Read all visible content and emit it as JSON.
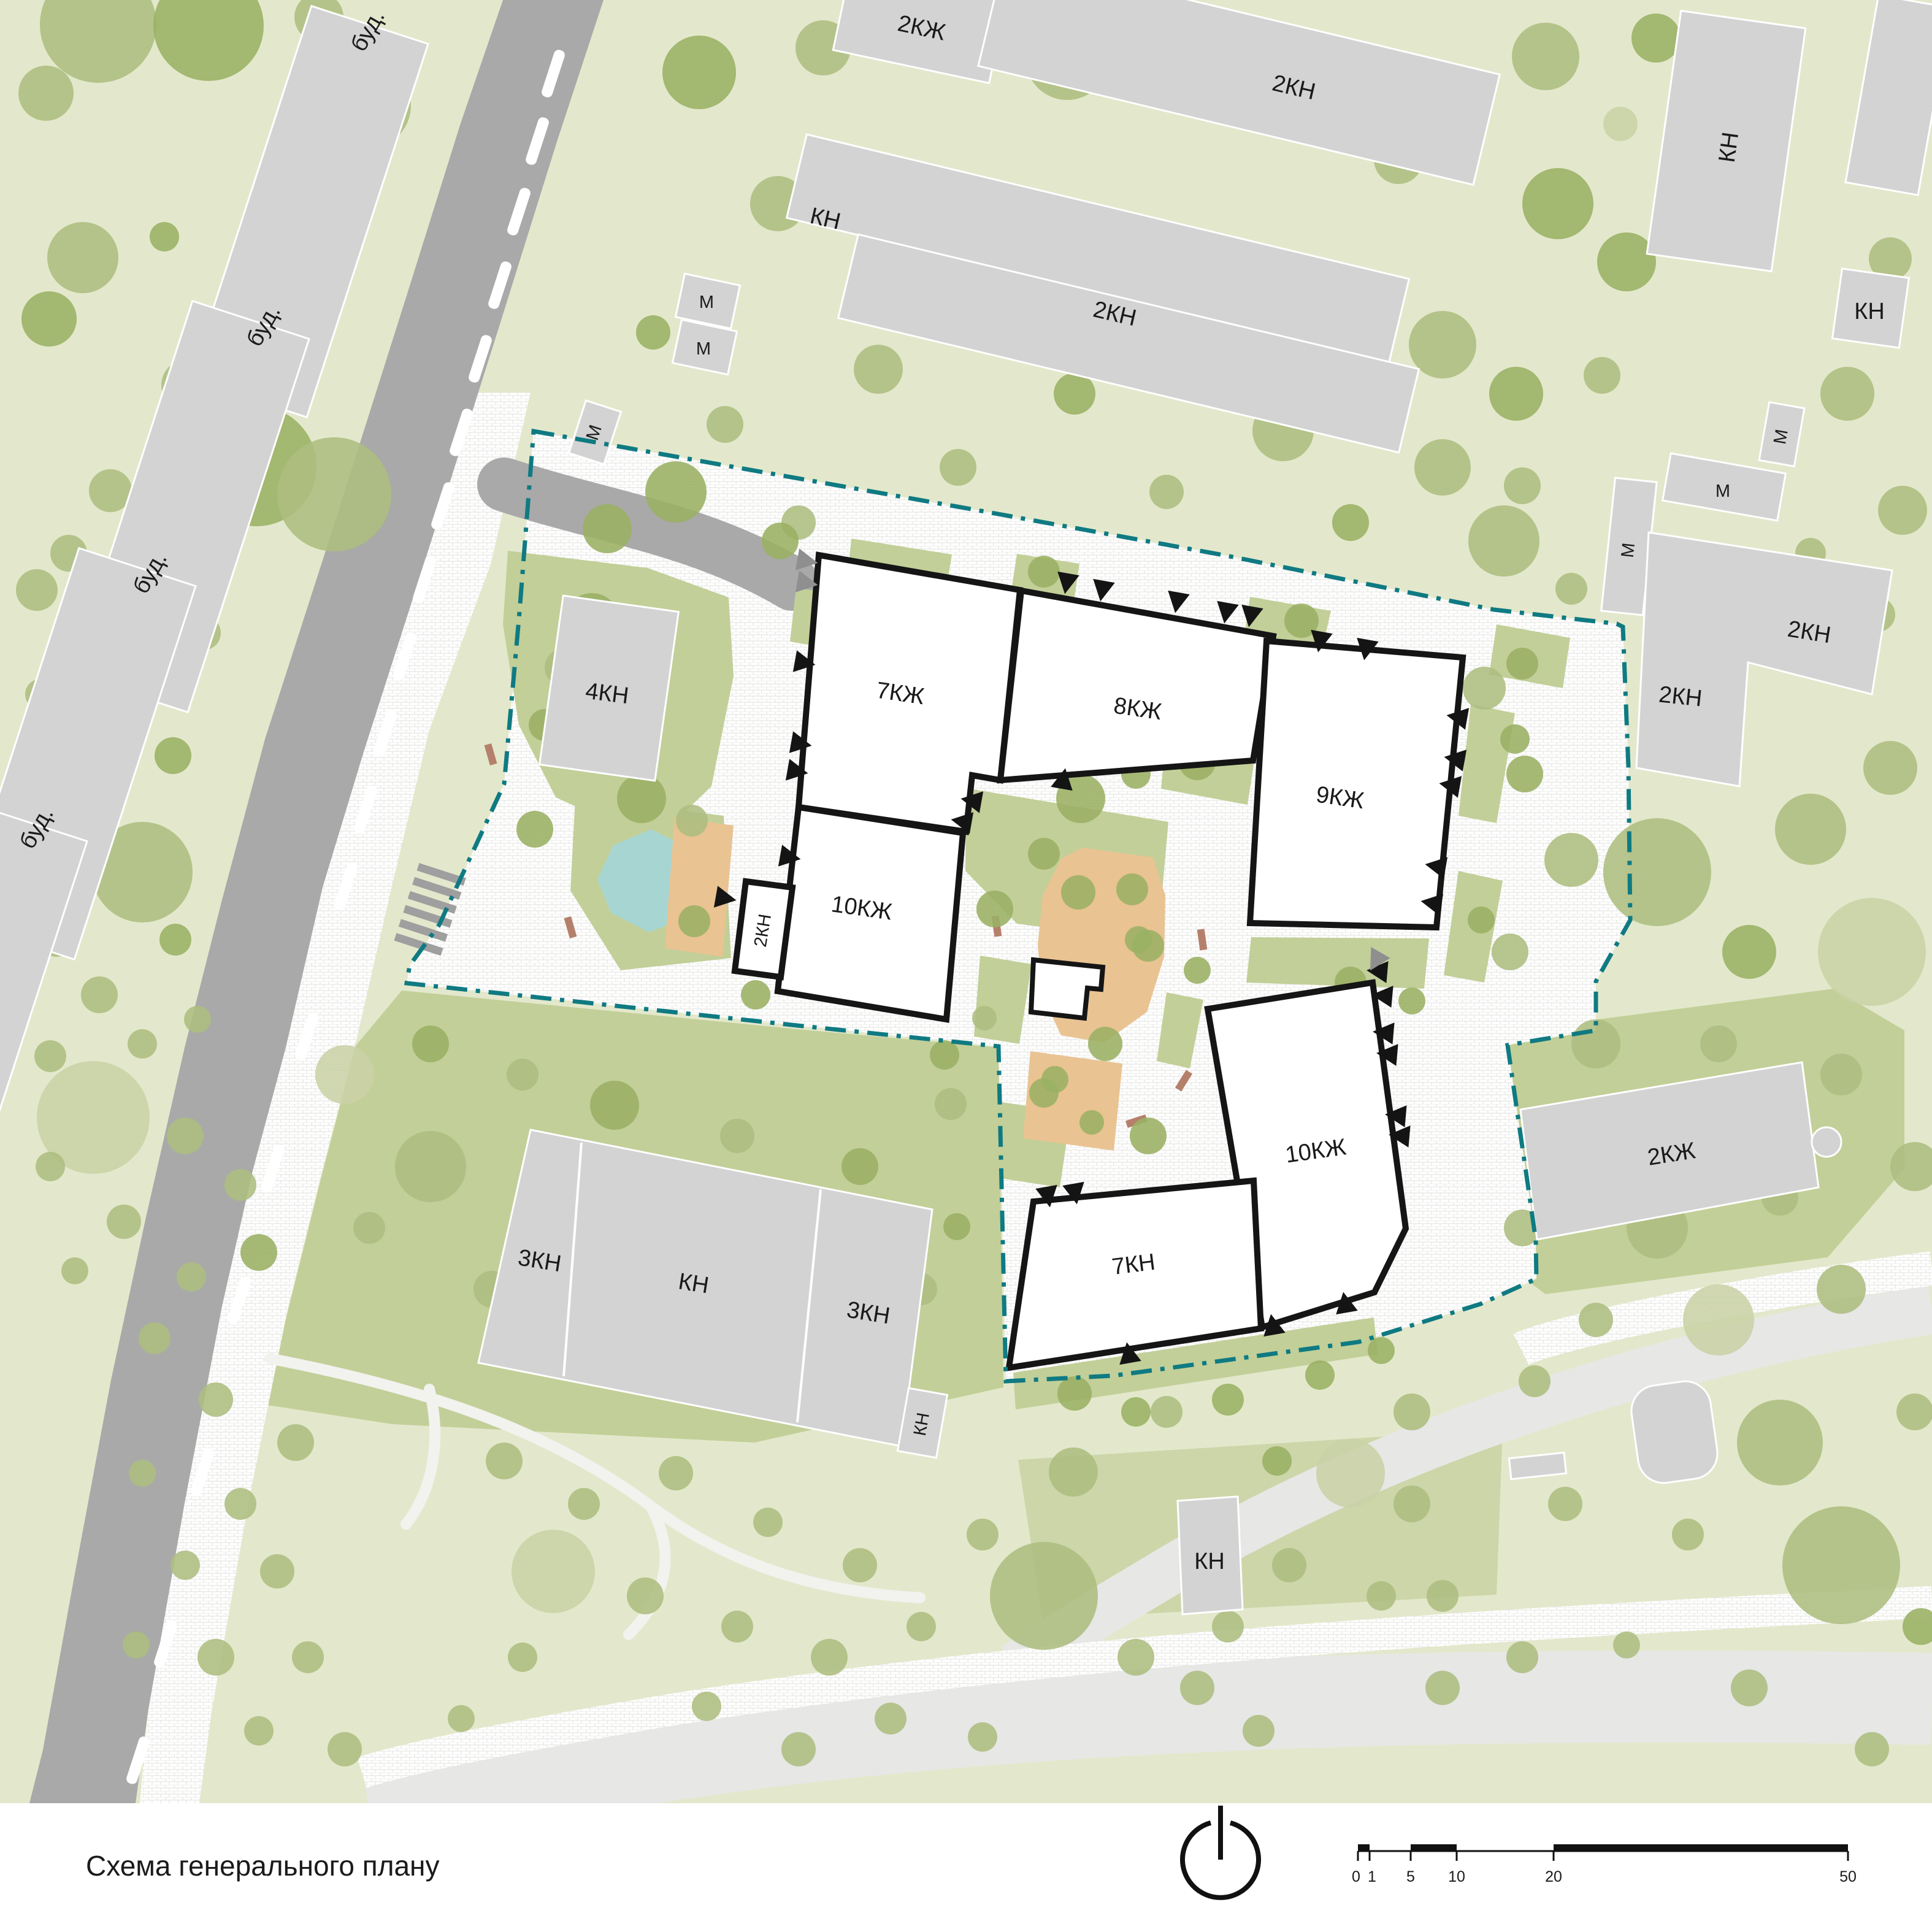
{
  "title": "Схема генерального плану",
  "colors": {
    "map_bg": "#e3e8cc",
    "lawn": "#c2cf98",
    "lawn_soft": "#ccd6a9",
    "tree_pale": "#c9d2a6",
    "tree_mid": "#adbd80",
    "tree_dark": "#9ab163",
    "road": "#a9a9a9",
    "road_pale": "#e7e7e5",
    "bld_gray": "#d3d3d3",
    "bld_stroke": "#ffffff",
    "new_fill": "#ffffff",
    "new_stroke": "#151515",
    "boundary": "#0f7a82",
    "pond": "#a7d6d2",
    "sand": "#e9c392",
    "bench": "#b5806b",
    "label": "#1a1a1a"
  },
  "labels": {
    "bud": "буд.",
    "kn": "КН",
    "kn2": "2КН",
    "kn3": "3КН",
    "kn4": "4КН",
    "kn7": "7КН",
    "kzh2": "2КЖ",
    "kzh7": "7КЖ",
    "kzh8": "8КЖ",
    "kzh9": "9КЖ",
    "kzh10": "10КЖ",
    "m": "М"
  },
  "scale": {
    "ticks": [
      "0",
      "1",
      "5",
      "10",
      "20",
      "50"
    ]
  },
  "trees": [
    [
      160,
      40,
      95,
      1
    ],
    [
      340,
      42,
      90,
      2
    ],
    [
      520,
      28,
      40,
      1
    ],
    [
      75,
      152,
      45,
      1
    ],
    [
      600,
      172,
      70,
      1
    ],
    [
      135,
      420,
      58,
      1
    ],
    [
      268,
      386,
      24,
      2
    ],
    [
      455,
      497,
      57,
      1
    ],
    [
      80,
      520,
      45,
      2
    ],
    [
      305,
      628,
      42,
      1
    ],
    [
      366,
      692,
      32,
      2
    ],
    [
      300,
      724,
      28,
      2
    ],
    [
      418,
      760,
      98,
      2
    ],
    [
      180,
      800,
      35,
      1
    ],
    [
      545,
      806,
      93,
      1
    ],
    [
      112,
      902,
      30,
      1
    ],
    [
      230,
      946,
      63,
      2
    ],
    [
      60,
      962,
      34,
      1
    ],
    [
      150,
      1062,
      30,
      0
    ],
    [
      332,
      1032,
      28,
      1
    ],
    [
      66,
      1132,
      25,
      1
    ],
    [
      222,
      1142,
      22,
      1
    ],
    [
      92,
      1232,
      45,
      1
    ],
    [
      282,
      1232,
      30,
      2
    ],
    [
      172,
      1322,
      26,
      1
    ],
    [
      62,
      1392,
      30,
      1
    ],
    [
      232,
      1422,
      82,
      1
    ],
    [
      92,
      1532,
      28,
      1
    ],
    [
      286,
      1532,
      26,
      2
    ],
    [
      162,
      1622,
      30,
      1
    ],
    [
      82,
      1722,
      26,
      1
    ],
    [
      232,
      1702,
      24,
      1
    ],
    [
      322,
      1662,
      22,
      1
    ],
    [
      152,
      1822,
      92,
      0
    ],
    [
      302,
      1852,
      30,
      1
    ],
    [
      82,
      1902,
      24,
      1
    ],
    [
      392,
      1932,
      26,
      1
    ],
    [
      202,
      1992,
      28,
      1
    ],
    [
      312,
      2082,
      24,
      1
    ],
    [
      122,
      2072,
      22,
      1
    ],
    [
      422,
      2042,
      30,
      2
    ],
    [
      252,
      2182,
      26,
      1
    ],
    [
      352,
      2282,
      28,
      1
    ],
    [
      482,
      2352,
      30,
      1
    ],
    [
      232,
      2402,
      22,
      1
    ],
    [
      392,
      2452,
      26,
      1
    ],
    [
      302,
      2552,
      24,
      1
    ],
    [
      452,
      2562,
      28,
      1
    ],
    [
      352,
      2702,
      30,
      1
    ],
    [
      222,
      2682,
      22,
      1
    ],
    [
      502,
      2702,
      26,
      1
    ],
    [
      422,
      2822,
      24,
      1
    ],
    [
      562,
      2852,
      28,
      1
    ],
    [
      1140,
      118,
      60,
      2
    ],
    [
      1342,
      78,
      45,
      1
    ],
    [
      1740,
      95,
      68,
      1
    ],
    [
      2280,
      260,
      40,
      1
    ],
    [
      1268,
      332,
      45,
      1
    ],
    [
      1612,
      378,
      40,
      2
    ],
    [
      1925,
      425,
      34,
      1
    ],
    [
      1065,
      542,
      28,
      2
    ],
    [
      1432,
      602,
      40,
      1
    ],
    [
      1752,
      642,
      34,
      2
    ],
    [
      2092,
      702,
      50,
      1
    ],
    [
      1182,
      692,
      30,
      1
    ],
    [
      2352,
      762,
      46,
      1
    ],
    [
      1562,
      762,
      30,
      1
    ],
    [
      1902,
      802,
      28,
      1
    ],
    [
      1102,
      802,
      50,
      2
    ],
    [
      1302,
      852,
      28,
      1
    ],
    [
      2202,
      852,
      30,
      2
    ],
    [
      2452,
      882,
      58,
      1
    ],
    [
      990,
      862,
      40,
      2
    ],
    [
      2520,
      92,
      55,
      1
    ],
    [
      2700,
      62,
      40,
      2
    ],
    [
      2642,
      202,
      28,
      0
    ],
    [
      2540,
      332,
      58,
      2
    ],
    [
      2652,
      427,
      48,
      2
    ],
    [
      2352,
      562,
      55,
      1
    ],
    [
      2472,
      642,
      44,
      2
    ],
    [
      2612,
      612,
      30,
      1
    ],
    [
      3082,
      422,
      35,
      1
    ],
    [
      3012,
      642,
      44,
      1
    ],
    [
      2482,
      792,
      30,
      1
    ],
    [
      2952,
      902,
      25,
      1
    ],
    [
      3102,
      832,
      40,
      1
    ],
    [
      3062,
      1002,
      28,
      1
    ],
    [
      2562,
      960,
      26,
      1
    ],
    [
      2420,
      1122,
      35,
      1
    ],
    [
      2486,
      1262,
      30,
      2
    ],
    [
      2562,
      1402,
      44,
      1
    ],
    [
      2462,
      1552,
      30,
      1
    ],
    [
      2702,
      1422,
      88,
      1
    ],
    [
      2952,
      1352,
      58,
      1
    ],
    [
      3082,
      1252,
      44,
      1
    ],
    [
      2852,
      1552,
      44,
      2
    ],
    [
      3052,
      1552,
      88,
      0
    ],
    [
      2602,
      1702,
      40,
      1
    ],
    [
      2802,
      1702,
      30,
      1
    ],
    [
      3002,
      1752,
      34,
      1
    ],
    [
      2552,
      1852,
      28,
      2
    ],
    [
      3122,
      1902,
      40,
      1
    ],
    [
      2482,
      2002,
      30,
      1
    ],
    [
      2702,
      2002,
      50,
      1
    ],
    [
      2902,
      1952,
      30,
      1
    ],
    [
      2602,
      2152,
      28,
      1
    ],
    [
      2802,
      2152,
      58,
      0
    ],
    [
      3002,
      2102,
      40,
      1
    ],
    [
      2502,
      2252,
      26,
      1
    ],
    [
      2702,
      2302,
      30,
      1
    ],
    [
      2902,
      2352,
      70,
      1
    ],
    [
      3122,
      2302,
      30,
      1
    ],
    [
      2552,
      2452,
      28,
      1
    ],
    [
      2752,
      2502,
      26,
      1
    ],
    [
      3002,
      2552,
      96,
      1
    ],
    [
      3132,
      2652,
      30,
      2
    ],
    [
      2482,
      2702,
      26,
      1
    ],
    [
      2652,
      2682,
      22,
      1
    ],
    [
      2852,
      2752,
      30,
      1
    ],
    [
      3052,
      2852,
      28,
      1
    ],
    [
      2302,
      2452,
      30,
      1
    ],
    [
      2352,
      2602,
      26,
      1
    ],
    [
      822,
      2382,
      30,
      1
    ],
    [
      952,
      2452,
      26,
      1
    ],
    [
      1102,
      2402,
      28,
      1
    ],
    [
      1252,
      2482,
      24,
      1
    ],
    [
      902,
      2562,
      68,
      0
    ],
    [
      1052,
      2602,
      30,
      1
    ],
    [
      1202,
      2652,
      26,
      1
    ],
    [
      1402,
      2552,
      28,
      1
    ],
    [
      1352,
      2702,
      30,
      1
    ],
    [
      1502,
      2652,
      24,
      1
    ],
    [
      1602,
      2502,
      26,
      1
    ],
    [
      1702,
      2602,
      88,
      1
    ],
    [
      1852,
      2702,
      30,
      1
    ],
    [
      2002,
      2652,
      26,
      1
    ],
    [
      2102,
      2552,
      28,
      1
    ],
    [
      2252,
      2602,
      24,
      1
    ],
    [
      1952,
      2752,
      28,
      1
    ],
    [
      1452,
      2802,
      26,
      1
    ],
    [
      1152,
      2782,
      24,
      1
    ],
    [
      1302,
      2852,
      28,
      1
    ],
    [
      1602,
      2832,
      24,
      1
    ],
    [
      2052,
      2822,
      26,
      1
    ],
    [
      2352,
      2752,
      28,
      1
    ],
    [
      852,
      2702,
      24,
      1
    ],
    [
      752,
      2802,
      22,
      1
    ],
    [
      2202,
      2402,
      56,
      0
    ],
    [
      2302,
      2302,
      30,
      1
    ],
    [
      1902,
      2302,
      26,
      1
    ],
    [
      2082,
      2382,
      24,
      2
    ],
    [
      1750,
      2400,
      40,
      1
    ],
    [
      702,
      1702,
      30,
      2
    ],
    [
      852,
      1752,
      26,
      1
    ],
    [
      1002,
      1802,
      40,
      2
    ],
    [
      1202,
      1852,
      28,
      1
    ],
    [
      1402,
      1902,
      30,
      2
    ],
    [
      702,
      1902,
      58,
      1
    ],
    [
      902,
      1952,
      28,
      1
    ],
    [
      1102,
      2002,
      26,
      1
    ],
    [
      1302,
      2052,
      28,
      2
    ],
    [
      1502,
      2102,
      26,
      1
    ],
    [
      802,
      2102,
      30,
      1
    ],
    [
      1002,
      2152,
      24,
      1
    ],
    [
      1202,
      2202,
      28,
      1
    ],
    [
      1452,
      2232,
      24,
      1
    ],
    [
      602,
      2002,
      26,
      1
    ],
    [
      562,
      1752,
      48,
      0
    ],
    [
      1550,
      1800,
      26,
      1
    ],
    [
      1560,
      2000,
      22,
      2
    ],
    [
      965,
      1012,
      45,
      2
    ],
    [
      918,
      1088,
      30,
      1
    ],
    [
      888,
      1182,
      26,
      2
    ],
    [
      1046,
      1302,
      40,
      2
    ],
    [
      1128,
      1338,
      26,
      1
    ],
    [
      872,
      1352,
      30,
      2
    ],
    [
      1022,
      1092,
      26,
      2
    ],
    [
      1762,
      1302,
      40,
      2
    ],
    [
      1852,
      1262,
      24,
      2
    ],
    [
      1952,
      1242,
      30,
      2
    ],
    [
      2098,
      1128,
      32,
      2
    ],
    [
      1702,
      1392,
      26,
      2
    ],
    [
      1622,
      1482,
      30,
      2
    ],
    [
      1872,
      1542,
      26,
      2
    ],
    [
      1952,
      1582,
      22,
      2
    ],
    [
      1802,
      1702,
      28,
      2
    ],
    [
      1702,
      1782,
      24,
      2
    ],
    [
      1872,
      1852,
      30,
      2
    ],
    [
      2202,
      1602,
      26,
      2
    ],
    [
      2302,
      1632,
      22,
      2
    ],
    [
      1752,
      2272,
      28,
      2
    ],
    [
      1852,
      2302,
      24,
      2
    ],
    [
      2002,
      2282,
      26,
      2
    ],
    [
      2152,
      2242,
      24,
      2
    ],
    [
      2252,
      2202,
      22,
      2
    ],
    [
      1682,
      2182,
      20,
      2
    ],
    [
      1702,
      932,
      26,
      2
    ],
    [
      2122,
      1012,
      28,
      2
    ],
    [
      2482,
      1082,
      26,
      2
    ],
    [
      1272,
      882,
      30,
      2
    ],
    [
      1355,
      1010,
      24,
      2
    ],
    [
      1132,
      1502,
      26,
      2
    ],
    [
      1232,
      1622,
      24,
      2
    ],
    [
      2082,
      1432,
      26,
      2
    ],
    [
      2470,
      1205,
      24,
      2
    ],
    [
      2415,
      1500,
      22,
      2
    ],
    [
      1540,
      1720,
      24,
      2
    ],
    [
      1605,
      1660,
      20,
      1
    ],
    [
      1758,
      1455,
      28,
      2
    ],
    [
      1846,
      1450,
      26,
      2
    ],
    [
      1856,
      1532,
      22,
      2
    ],
    [
      1720,
      1760,
      22,
      2
    ],
    [
      1780,
      1830,
      20,
      2
    ]
  ],
  "entrances": [
    [
      1742,
      935,
      100
    ],
    [
      1800,
      947,
      100
    ],
    [
      1922,
      966,
      100
    ],
    [
      2002,
      983,
      100
    ],
    [
      2042,
      989,
      100
    ],
    [
      2155,
      1030,
      100
    ],
    [
      2230,
      1043,
      100
    ],
    [
      1296,
      1078,
      10
    ],
    [
      1290,
      1210,
      10
    ],
    [
      1284,
      1255,
      10
    ],
    [
      1272,
      1395,
      10
    ],
    [
      1167,
      1462,
      10
    ],
    [
      1600,
      1308,
      190
    ],
    [
      1584,
      1342,
      190
    ],
    [
      1731,
      1286,
      280
    ],
    [
      2392,
      1172,
      190
    ],
    [
      2388,
      1240,
      190
    ],
    [
      2380,
      1283,
      190
    ],
    [
      2357,
      1415,
      190
    ],
    [
      2350,
      1475,
      190
    ],
    [
      2262,
      1585,
      185
    ],
    [
      2270,
      1625,
      185
    ],
    [
      2272,
      1685,
      185
    ],
    [
      2278,
      1720,
      185
    ],
    [
      2292,
      1820,
      185
    ],
    [
      2298,
      1853,
      185
    ],
    [
      1706,
      1935,
      80
    ],
    [
      1750,
      1930,
      80
    ],
    [
      1843,
      2222,
      260
    ],
    [
      2078,
      2176,
      260
    ],
    [
      2196,
      2140,
      260
    ],
    [
      1300,
      912,
      10,
      "g"
    ],
    [
      1300,
      948,
      10,
      "g"
    ],
    [
      2251,
      1553,
      120,
      "g"
    ]
  ],
  "road_dashes": [
    [
      902,
      120
    ],
    [
      876,
      230
    ],
    [
      846,
      345
    ],
    [
      815,
      465
    ],
    [
      783,
      585
    ],
    [
      752,
      705
    ],
    [
      722,
      825
    ],
    [
      692,
      945
    ],
    [
      660,
      1070
    ],
    [
      628,
      1195
    ],
    [
      596,
      1320
    ],
    [
      564,
      1445
    ],
    [
      500,
      1690
    ],
    [
      445,
      1905
    ],
    [
      390,
      2120
    ],
    [
      330,
      2400
    ],
    [
      270,
      2680
    ],
    [
      225,
      2870
    ]
  ],
  "benches": [
    [
      1625,
      1510,
      82
    ],
    [
      1960,
      1532,
      82
    ],
    [
      1930,
      1762,
      -58
    ],
    [
      1853,
      1828,
      -18
    ],
    [
      930,
      1512,
      74
    ],
    [
      800,
      1230,
      74
    ]
  ]
}
